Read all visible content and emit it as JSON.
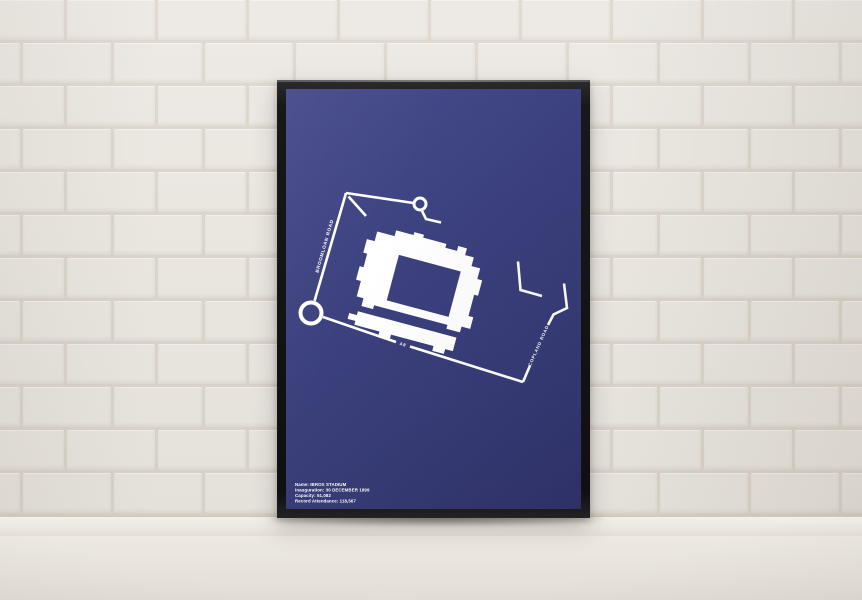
{
  "poster": {
    "colors": {
      "background": "#383d7b",
      "artwork": "#ffffff"
    },
    "map_labels": {
      "road_left": "BROOMLOAN ROAD",
      "road_right": "COPLAND ROAD",
      "road_bottom": "A8"
    },
    "info_lines": [
      "Name: IBROX STADIUM",
      "Inauguration: 30 DECEMBER 1899",
      "Capacity: 51,082",
      "Record Attendance: 118,567"
    ]
  },
  "scene": {
    "wall_color": "#ebe8e2",
    "shelf_color": "#ece8e1",
    "frame_color": "#141417"
  }
}
